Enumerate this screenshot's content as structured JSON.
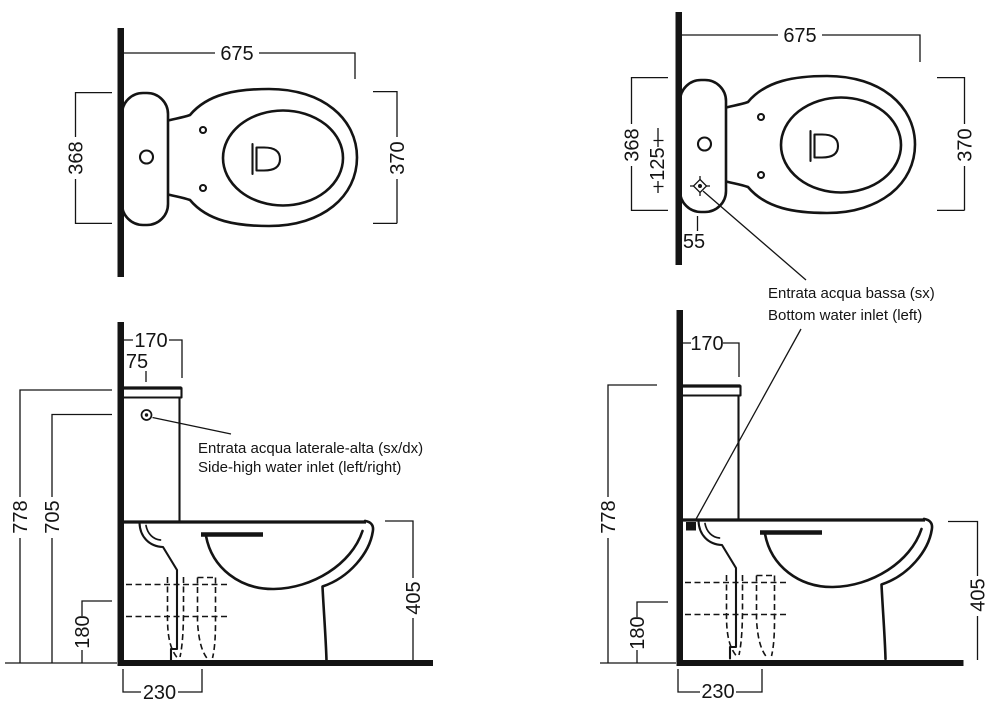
{
  "drawing": {
    "top_left": {
      "width": "675",
      "depth": "368",
      "bowl_width": "370"
    },
    "top_right": {
      "width": "675",
      "depth": "368",
      "inlet_offset": "125",
      "inlet_wall_offset": "55",
      "bowl_width": "370"
    },
    "side_left": {
      "tank_depth": "170",
      "inlet_setback": "75",
      "total_height": "778",
      "inlet_height": "705",
      "outlet_height": "180",
      "outlet_depth": "230",
      "rim_height": "405"
    },
    "side_right": {
      "tank_depth": "170",
      "total_height": "778",
      "outlet_height": "180",
      "outlet_depth": "230",
      "rim_height": "405"
    },
    "annotations": {
      "side_high": {
        "line1": "Entrata acqua laterale-alta (sx/dx)",
        "line2": "Side-high water inlet (left/right)"
      },
      "bottom": {
        "line1": "Entrata acqua bassa (sx)",
        "line2": "Bottom water inlet (left)"
      }
    },
    "colors": {
      "ink": "#141414",
      "background": "#ffffff"
    }
  }
}
